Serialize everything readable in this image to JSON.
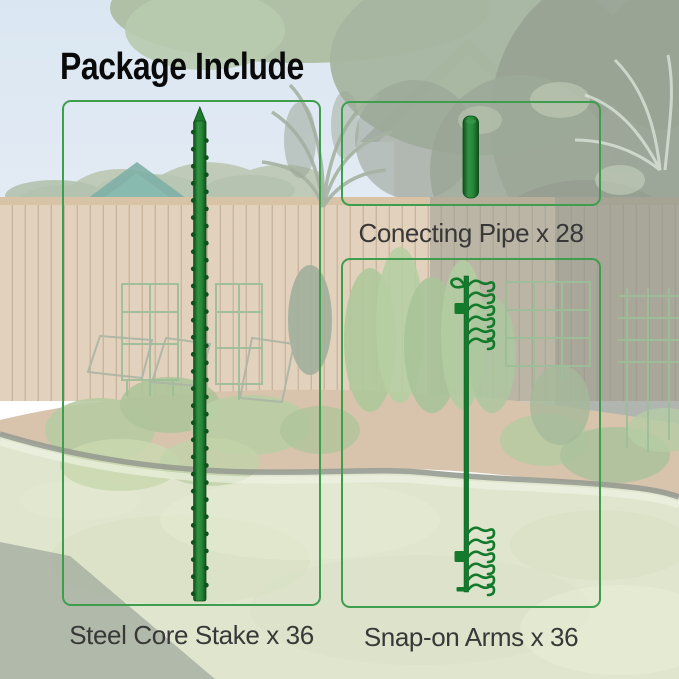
{
  "title": "Package Include",
  "parts": {
    "stake": {
      "name": "steel-core-stake",
      "label": "Steel Core Stake x 36"
    },
    "pipe": {
      "name": "connecting-pipe",
      "label": "Conecting Pipe x 28"
    },
    "arms": {
      "name": "snap-on-arms",
      "label": "Snap-on Arms x 36"
    }
  },
  "colors": {
    "box_border": "#3f9e4e",
    "title_text": "#0a0a0a",
    "label_text": "#383838",
    "part_green_dark": "#155c20",
    "part_green_mid": "#2f9440",
    "background_veil": "#ffffff"
  }
}
